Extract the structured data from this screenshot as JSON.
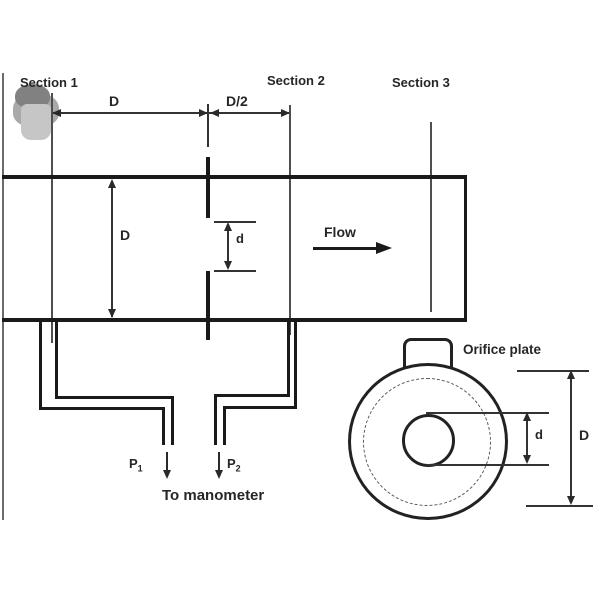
{
  "labels": {
    "section1": "Section 1",
    "section2": "Section 2",
    "section3": "Section 3",
    "flow": "Flow",
    "to_manometer": "To manometer",
    "orifice_plate": "Orifice plate"
  },
  "dimensions": {
    "upstream_spacing": "D",
    "downstream_spacing": "D/2",
    "pipe_diameter": "D",
    "orifice_diameter": "d",
    "front_orifice_diameter": "d",
    "front_pipe_diameter": "D"
  },
  "pressure_taps": {
    "p1_base": "P",
    "p1_sub": "1",
    "p2_base": "P",
    "p2_sub": "2"
  },
  "colors": {
    "background": "#ffffff",
    "line_dark": "#1a1a1a",
    "line_thin": "#4f4f4f",
    "text": "#262626",
    "smudge_dark": "#818181",
    "smudge_mid": "#a9a9a9",
    "smudge_light": "#c6c6c6"
  }
}
